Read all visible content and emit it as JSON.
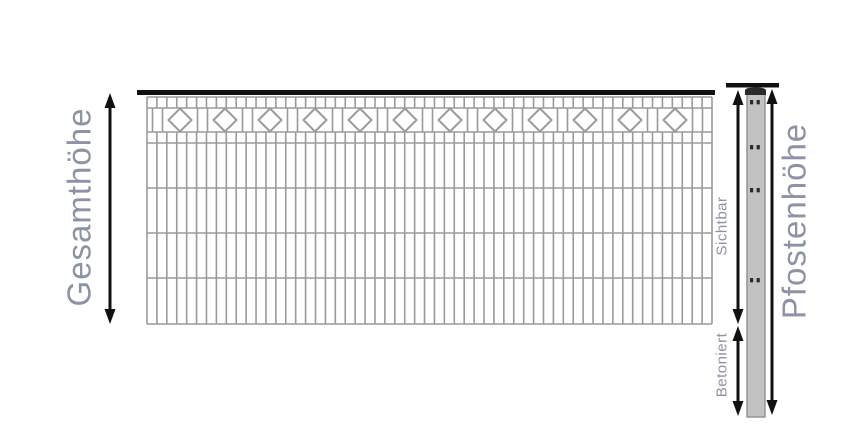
{
  "labels": {
    "total_height": "Gesamthöhe",
    "post_height": "Pfostenhöhe",
    "visible": "Sichtbar",
    "concreted": "Betoniert"
  },
  "colors": {
    "background": "#ffffff",
    "fence_line": "#9a9a9a",
    "rail": "#111111",
    "arrow": "#111111",
    "label_text": "#8c93a6",
    "post_fill": "#c2c2c2",
    "post_border": "#8f8f8f",
    "post_cap": "#2a2a2a",
    "post_hole": "#2a2a2a"
  },
  "diagram": {
    "canvas": {
      "width": 850,
      "height": 425
    },
    "fence": {
      "left": 147,
      "right": 712,
      "top": 97,
      "bottom": 324,
      "rail": {
        "x1": 137,
        "x2": 715,
        "y": 90,
        "height": 5
      },
      "h_lines": [
        97,
        108,
        132,
        143,
        188,
        233,
        278,
        324
      ],
      "cell_width": 10,
      "cell_bands": [
        [
          97,
          108
        ],
        [
          132,
          324
        ]
      ],
      "diamond_row": {
        "top": 108,
        "bottom": 132,
        "first_pair_x": 152.5,
        "section_width": 45,
        "pair_gap": 10,
        "pair_count": 13
      },
      "diamonds": {
        "count": 12,
        "first_cx": 180,
        "spacing": 45,
        "cy": 120,
        "half_diagonal": 11.5
      },
      "line_width": 1.6,
      "diamond_line_width": 2
    },
    "post": {
      "rail": {
        "x1": 726,
        "x2": 779,
        "y": 83,
        "height": 4.5
      },
      "x": 747,
      "width": 18,
      "top": 92,
      "bottom": 417,
      "cap": {
        "x": 745,
        "width": 21,
        "top": 87.5,
        "bottom": 95
      },
      "hole_ys": [
        100,
        145,
        188,
        278
      ],
      "hole": {
        "x1": 750,
        "x2": 756.6,
        "width": 3.2,
        "height": 4.4
      }
    },
    "arrows": [
      {
        "name": "gesamthoehe-arrow",
        "x": 110,
        "y1": 93,
        "y2": 324
      },
      {
        "name": "sichtbar-arrow",
        "x": 738,
        "y1": 90,
        "y2": 324
      },
      {
        "name": "betoniert-arrow",
        "x": 738,
        "y1": 326,
        "y2": 416
      },
      {
        "name": "pfostenhoehe-arrow",
        "x": 772,
        "y1": 89,
        "y2": 415
      }
    ],
    "arrow_style": {
      "line_width": 3,
      "head_width": 11,
      "head_length": 15
    }
  }
}
